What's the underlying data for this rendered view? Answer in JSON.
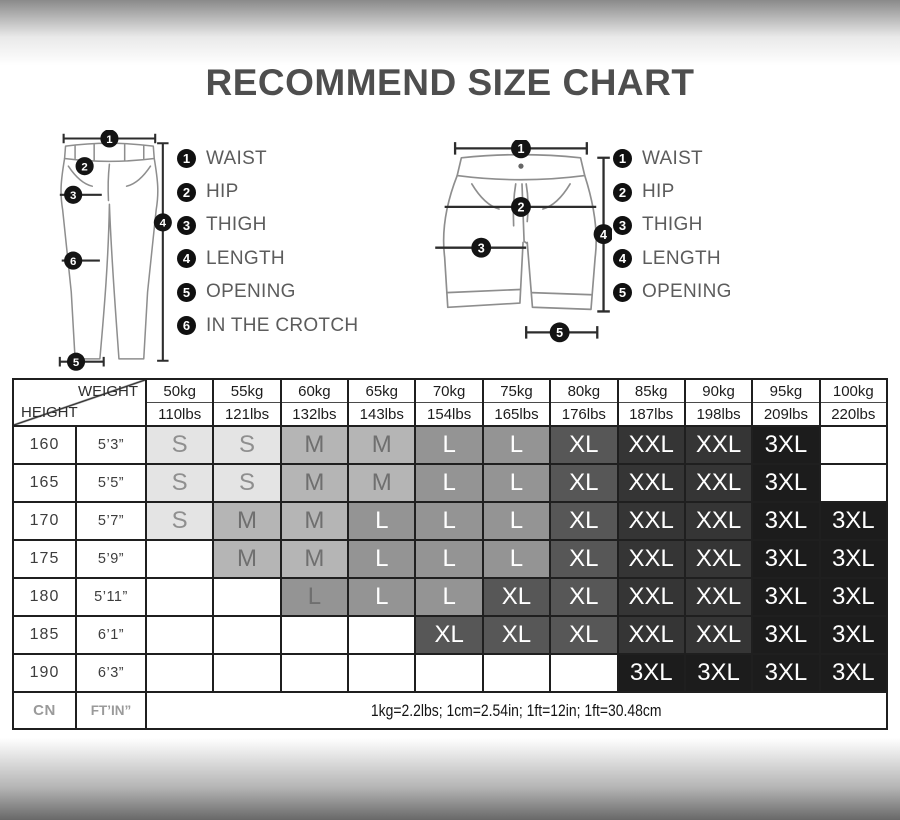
{
  "title": "RECOMMEND SIZE CHART",
  "diagrams": {
    "pants": {
      "name": "long-pants",
      "markers": [
        "1",
        "2",
        "3",
        "4",
        "5",
        "6"
      ],
      "legend": [
        {
          "num": "1",
          "label": "WAIST"
        },
        {
          "num": "2",
          "label": "HIP"
        },
        {
          "num": "3",
          "label": "THIGH"
        },
        {
          "num": "4",
          "label": "LENGTH"
        },
        {
          "num": "5",
          "label": "OPENING"
        },
        {
          "num": "6",
          "label": "IN THE CROTCH"
        }
      ]
    },
    "shorts": {
      "name": "shorts",
      "markers": [
        "1",
        "2",
        "3",
        "4",
        "5"
      ],
      "legend": [
        {
          "num": "1",
          "label": "WAIST"
        },
        {
          "num": "2",
          "label": "HIP"
        },
        {
          "num": "3",
          "label": "THIGH"
        },
        {
          "num": "4",
          "label": "LENGTH"
        },
        {
          "num": "5",
          "label": "OPENING"
        }
      ]
    }
  },
  "size_table": {
    "corner": {
      "top_label": "WEIGHT",
      "bottom_label": "HEIGHT"
    },
    "weight_columns": [
      {
        "kg": "50kg",
        "lbs": "110lbs"
      },
      {
        "kg": "55kg",
        "lbs": "121lbs"
      },
      {
        "kg": "60kg",
        "lbs": "132lbs"
      },
      {
        "kg": "65kg",
        "lbs": "143lbs"
      },
      {
        "kg": "70kg",
        "lbs": "154lbs"
      },
      {
        "kg": "75kg",
        "lbs": "165lbs"
      },
      {
        "kg": "80kg",
        "lbs": "176lbs"
      },
      {
        "kg": "85kg",
        "lbs": "187lbs"
      },
      {
        "kg": "90kg",
        "lbs": "198lbs"
      },
      {
        "kg": "95kg",
        "lbs": "209lbs"
      },
      {
        "kg": "100kg",
        "lbs": "220lbs"
      }
    ],
    "rows": [
      {
        "cn": "160",
        "ftin": "5’3”",
        "sizes": [
          "S",
          "S",
          "M",
          "M",
          "L",
          "L",
          "XL",
          "XXL",
          "XXL",
          "3XL",
          ""
        ]
      },
      {
        "cn": "165",
        "ftin": "5’5”",
        "sizes": [
          "S",
          "S",
          "M",
          "M",
          "L",
          "L",
          "XL",
          "XXL",
          "XXL",
          "3XL",
          ""
        ]
      },
      {
        "cn": "170",
        "ftin": "5’7”",
        "sizes": [
          "S",
          "M",
          "M",
          "L",
          "L",
          "L",
          "XL",
          "XXL",
          "XXL",
          "3XL",
          "3XL"
        ]
      },
      {
        "cn": "175",
        "ftin": "5’9”",
        "sizes": [
          "",
          "M",
          "M",
          "L",
          "L",
          "L",
          "XL",
          "XXL",
          "XXL",
          "3XL",
          "3XL"
        ]
      },
      {
        "cn": "180",
        "ftin": "5’11”",
        "sizes": [
          "",
          "",
          "L",
          "L",
          "L",
          "XL",
          "XL",
          "XXL",
          "XXL",
          "3XL",
          "3XL"
        ]
      },
      {
        "cn": "185",
        "ftin": "6’1”",
        "sizes": [
          "",
          "",
          "",
          "",
          "XL",
          "XL",
          "XL",
          "XXL",
          "XXL",
          "3XL",
          "3XL"
        ]
      },
      {
        "cn": "190",
        "ftin": "6’3”",
        "sizes": [
          "",
          "",
          "",
          "",
          "",
          "",
          "",
          "3XL",
          "3XL",
          "3XL",
          "3XL"
        ]
      }
    ],
    "palette": {
      "S": {
        "bg": "#e4e4e4",
        "fg": "#8f8f8f"
      },
      "M": {
        "bg": "#b5b5b5",
        "fg": "#6f6f6f"
      },
      "L": {
        "bg": "#949494",
        "fg": "#ffffff"
      },
      "XL": {
        "bg": "#575757",
        "fg": "#ffffff"
      },
      "XXL": {
        "bg": "#353535",
        "fg": "#ffffff"
      },
      "3XL": {
        "bg": "#1c1c1c",
        "fg": "#ffffff"
      }
    },
    "special_cells": [
      {
        "row": 4,
        "col": 2,
        "fg": "#6f6f6f"
      }
    ],
    "footer": {
      "cn_label": "CN",
      "ftin_label": "FT’IN”",
      "note": "1kg=2.2lbs; 1cm=2.54in; 1ft=12in; 1ft=30.48cm"
    }
  }
}
